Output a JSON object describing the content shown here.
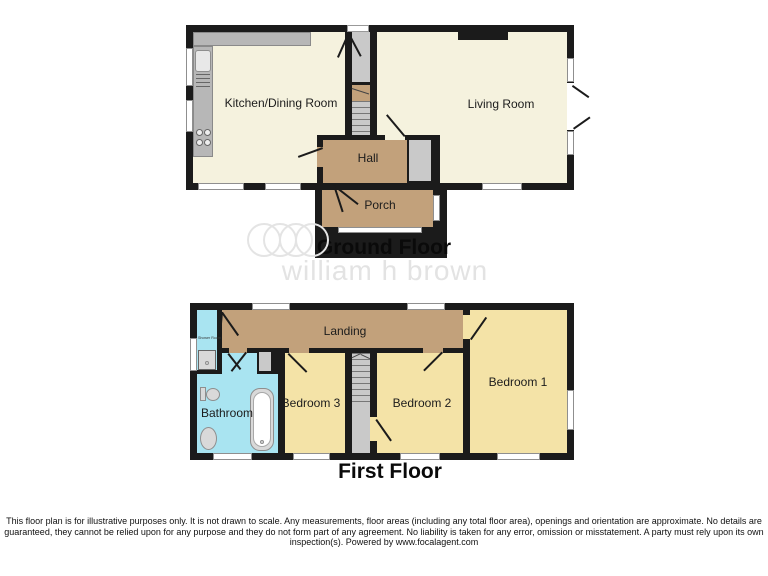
{
  "ground_floor": {
    "title": "Ground Floor",
    "rooms": {
      "kitchen": "Kitchen/Dining Room",
      "living": "Living Room",
      "hall": "Hall",
      "porch": "Porch"
    }
  },
  "first_floor": {
    "title": "First Floor",
    "rooms": {
      "landing": "Landing",
      "shower_room": "Shower Room",
      "bathroom": "Bathroom",
      "bedroom3": "Bedroom 3",
      "bedroom2": "Bedroom 2",
      "bedroom1": "Bedroom 1"
    }
  },
  "watermark": {
    "brand": "william h brown"
  },
  "footer": {
    "disclaimer": "This floor plan is for illustrative purposes only. It is not drawn to scale. Any measurements, floor areas (including any total floor area), openings and orientation are approximate. No details are guaranteed, they cannot be relied upon for any purpose and they do not form part of any agreement. No liability is taken for any error, omission or misstatement. A party must rely upon its own inspection(s). Powered by www.focalagent.com"
  },
  "colors": {
    "wall": "#1b1b1b",
    "cream": "#f5f2de",
    "tan": "#c2a17b",
    "yellow": "#f4e3a7",
    "cyan": "#a9e4f1",
    "stair-gray": "#c9c9c9",
    "counter-gray": "#b7b7b7",
    "fixture-gray": "#d9d9d9",
    "watermark-gray": "#e3e3e3"
  }
}
